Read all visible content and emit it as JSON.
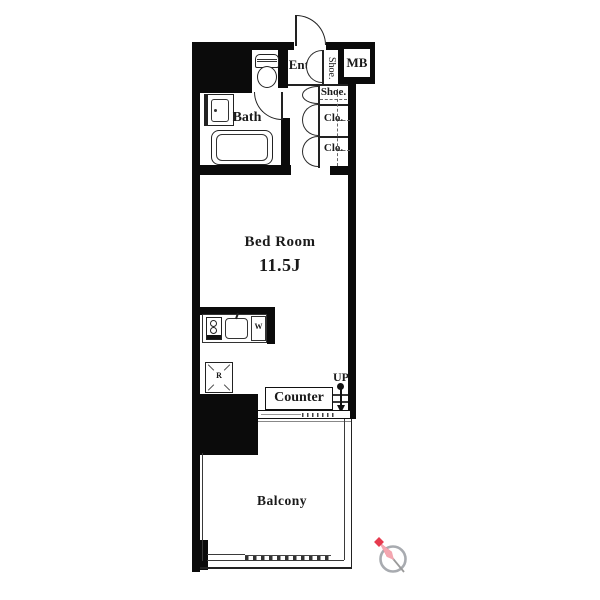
{
  "plan": {
    "bedroom": {
      "name": "Bed Room",
      "size": "11.5J"
    },
    "bath": {
      "label": "Bath"
    },
    "entry": {
      "label": "Entry"
    },
    "balcony": {
      "label": "Balcony"
    },
    "counter": {
      "label": "Counter"
    },
    "meter_box": {
      "label": "MB"
    },
    "shoe_cabinet": {
      "label": "Shoe."
    },
    "shoe_closet": {
      "label": "Shoe."
    },
    "closet_upper": {
      "label": "Clo."
    },
    "closet_lower": {
      "label": "Clo."
    },
    "stairs": {
      "label": "UP"
    },
    "refrigerator": {
      "label": "R"
    },
    "washer": {
      "label": "W"
    }
  },
  "icons": {
    "compass": "compass-north-icon"
  },
  "colors": {
    "wall": "#000000",
    "line": "#2b2b2b",
    "compass_red": "#e63a4e",
    "compass_ring": "#a8abb0"
  }
}
